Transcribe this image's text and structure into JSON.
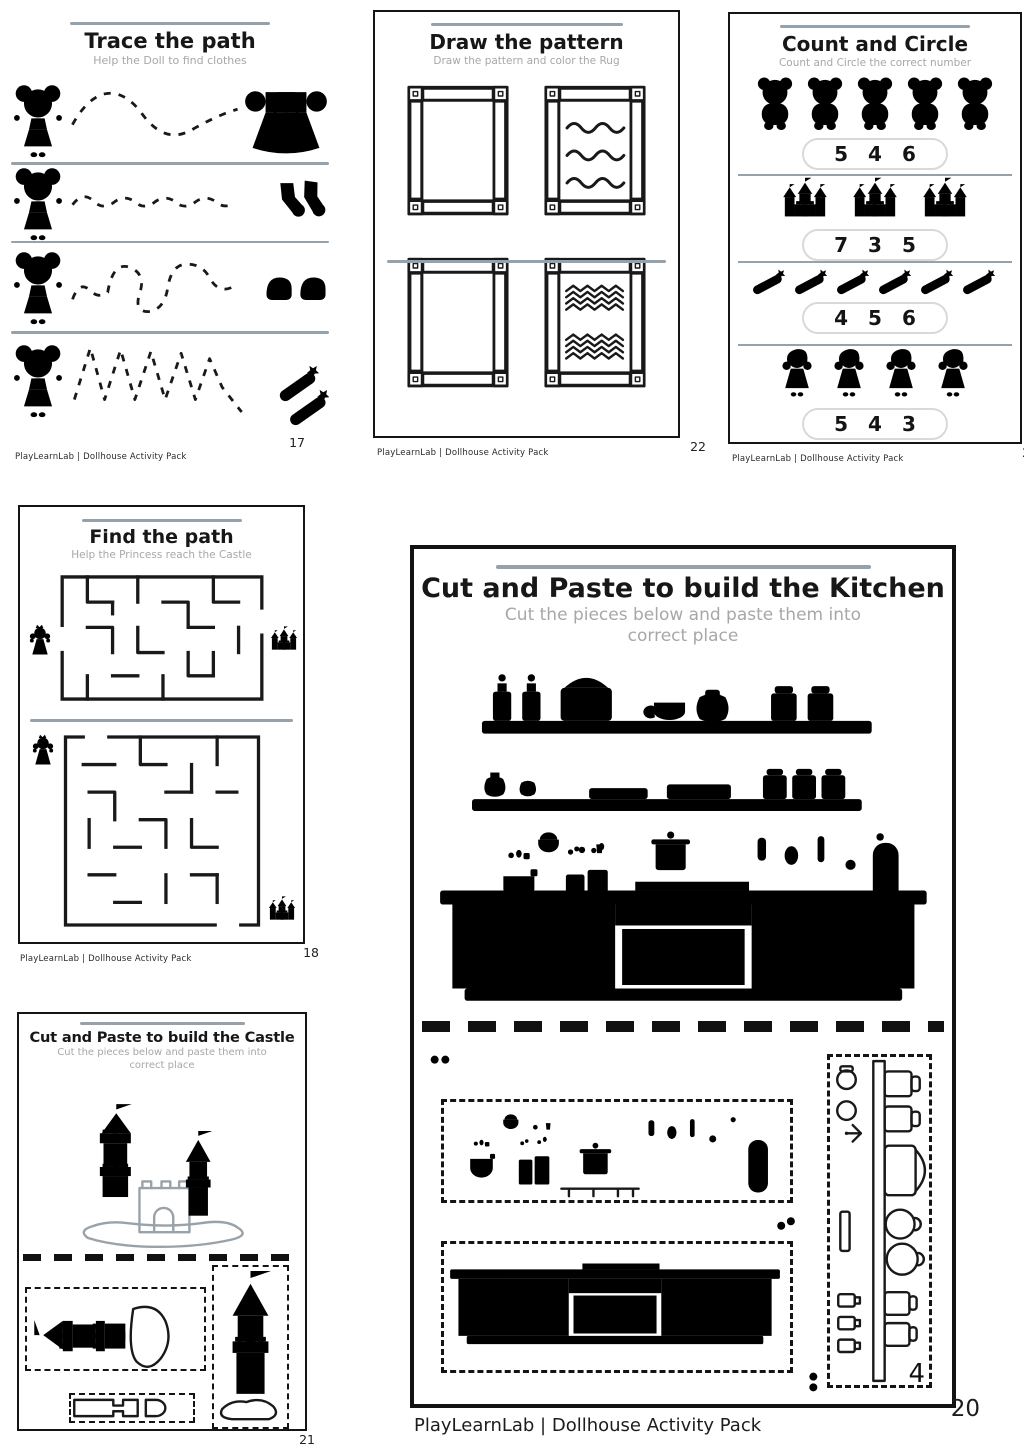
{
  "footer_brand": "PlayLearnLab | Dollhouse Activity Pack",
  "colors": {
    "accent_line": "#95a2ab",
    "subtitle_gray": "#a7a7a7",
    "castle_art_gray": "#9aa2a9",
    "kitchen_art_gray": "#8b95a2",
    "ink": "#191919"
  },
  "pages": {
    "trace": {
      "title": "Trace the path",
      "subtitle": "Help the Doll to find clothes",
      "page_number": "17",
      "rows": [
        {
          "start": "doll",
          "target": "dress",
          "path": "wave_big"
        },
        {
          "start": "doll",
          "target": "socks",
          "path": "wave_small"
        },
        {
          "start": "doll",
          "target": "shoes",
          "path": "wave_mixed"
        },
        {
          "start": "doll",
          "target": "clips",
          "path": "zigzag"
        }
      ]
    },
    "pattern": {
      "title": "Draw the pattern",
      "subtitle": "Draw the pattern and color the Rug",
      "page_number": "22",
      "rugs": [
        {
          "pattern": "empty"
        },
        {
          "pattern": "waves"
        },
        {
          "pattern": "empty"
        },
        {
          "pattern": "zigzag"
        }
      ]
    },
    "count": {
      "title": "Count and Circle",
      "subtitle": "Count and Circle the correct number",
      "page_number": "24",
      "rows": [
        {
          "item": "bear",
          "count": 5,
          "options": [
            "5",
            "4",
            "6"
          ]
        },
        {
          "item": "castle",
          "count": 3,
          "options": [
            "7",
            "3",
            "5"
          ]
        },
        {
          "item": "clip",
          "count": 6,
          "options": [
            "4",
            "5",
            "6"
          ]
        },
        {
          "item": "doll",
          "count": 4,
          "options": [
            "5",
            "4",
            "3"
          ]
        }
      ]
    },
    "maze": {
      "title": "Find the path",
      "subtitle": "Help the Princess reach the Castle",
      "page_number": "18"
    },
    "castle": {
      "title": "Cut and Paste to build the Castle",
      "subtitle": "Cut the pieces below and paste them into correct place",
      "page_number": "21"
    },
    "kitchen": {
      "title": "Cut and Paste to build the Kitchen",
      "subtitle": "Cut the pieces below and paste them into correct place",
      "page_number": "20",
      "piece_label": "4"
    }
  }
}
